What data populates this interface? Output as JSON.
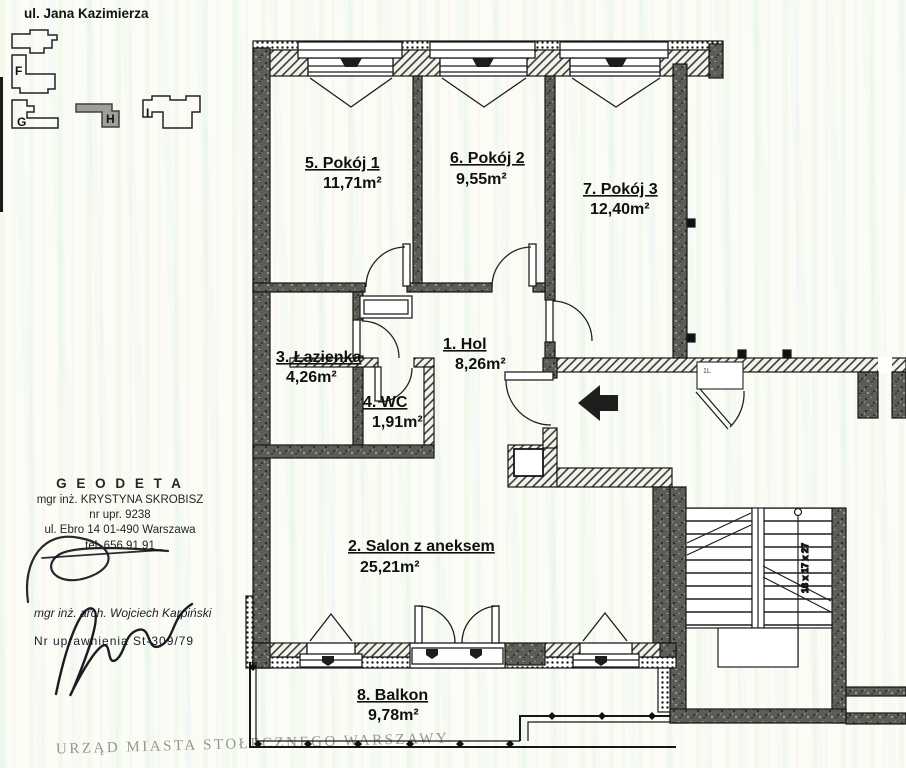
{
  "header": {
    "street": "ul. Jana Kazimierza"
  },
  "site_plan": {
    "buildings": [
      {
        "label": "F"
      },
      {
        "label": "G"
      },
      {
        "label": "H"
      },
      {
        "label": "I"
      }
    ]
  },
  "apartment": {
    "rooms": [
      {
        "title": "1. Hol",
        "area": "8,26m²"
      },
      {
        "title": "2. Salon z aneksem",
        "area": "25,21m²"
      },
      {
        "title": "3. Łazienka",
        "area": "4,26m²"
      },
      {
        "title": "4. WC",
        "area": "1,91m²"
      },
      {
        "title": "5. Pokój 1",
        "area": "11,71m²"
      },
      {
        "title": "6. Pokój 2",
        "area": "9,55m²"
      },
      {
        "title": "7. Pokój 3",
        "area": "12,40m²"
      },
      {
        "title": "8. Balkon",
        "area": "9,78m²"
      }
    ]
  },
  "stairs": {
    "dimensions": "18 x 17 x 27",
    "niche_label": "1L"
  },
  "stamps": {
    "surveyor": {
      "heading": "G E O D E T A",
      "name": "mgr inż. KRYSTYNA SKROBISZ",
      "license": "nr upr. 9238",
      "address": "ul. Ebro 14  01-490 Warszawa",
      "phone": "tel. 656 91 91"
    },
    "architect": {
      "name": "mgr inż. arch. Wojciech Karpiński",
      "license": "Nr uprawnienia  St-309/79"
    }
  },
  "footer": {
    "office_stamp": "URZĄD MIASTA STOŁECZNEGO WARSZAWY"
  }
}
